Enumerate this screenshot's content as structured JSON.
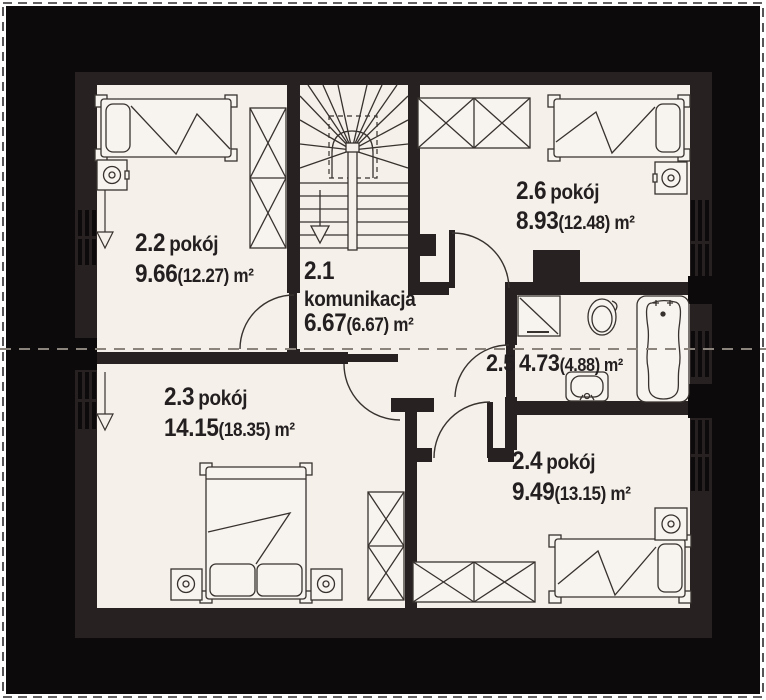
{
  "plan_type": "floor-plan-upper-storey",
  "rooms": {
    "r21": {
      "number": "2.1",
      "name": "komunikacja",
      "area": "6.67",
      "total": "(6.67) m²"
    },
    "r22": {
      "number": "2.2",
      "name": "pokój",
      "area": "9.66",
      "total": "(12.27) m²"
    },
    "r23": {
      "number": "2.3",
      "name": "pokój",
      "area": "14.15",
      "total": "(18.35) m²"
    },
    "r24": {
      "number": "2.4",
      "name": "pokój",
      "area": "9.49",
      "total": "(13.15) m²"
    },
    "r25": {
      "number": "2.5",
      "area": "4.73",
      "total": "(4.88) m²"
    },
    "r26": {
      "number": "2.6",
      "name": "pokój",
      "area": "8.93",
      "total": "(12.48) m²"
    }
  },
  "colors": {
    "roof_zone": "#0d0a0b",
    "wall": "#272122",
    "floor": "#f5f0e9",
    "line": "#38322f",
    "dashed_headroom_line": "#8a847d",
    "text": "#231f20"
  }
}
